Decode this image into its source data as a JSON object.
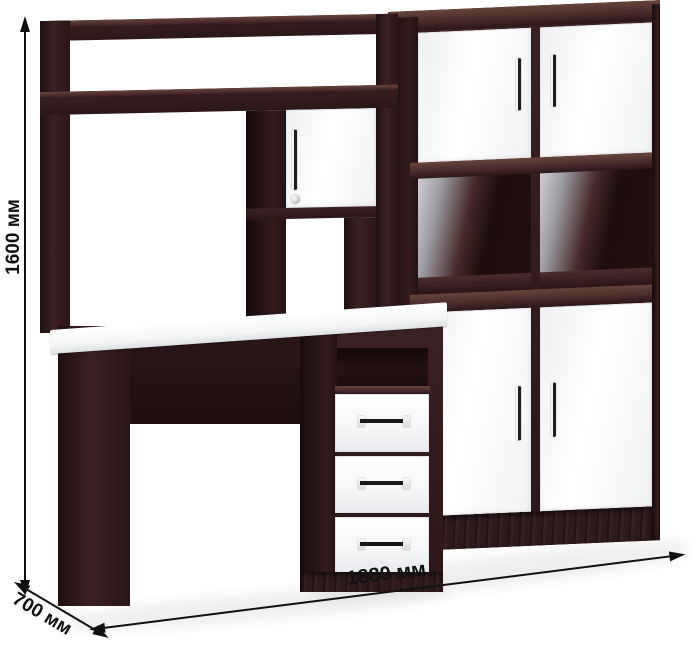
{
  "annotations": {
    "height_label": "1600 мм",
    "width_label": "1880 мм",
    "depth_label": "700 мм"
  },
  "palette": {
    "background": "#ffffff",
    "wood_dark": "#2b1618",
    "wood_mid": "#3a2123",
    "wood_highlight": "#66443a",
    "facade_white": "#fbfcfd",
    "back_panel_grey": "#9b9ba0",
    "handle_metal": "#1d1d1d",
    "annotation_color": "#101010"
  },
  "furniture": {
    "style": "dark wenge frame with glossy white facades",
    "hutch": {
      "open_top_shelf": true,
      "tall_open_bay": true,
      "small_doors": 1,
      "door_has_lock": true,
      "open_niche_below_door": true
    },
    "desk": {
      "desktop_color": "white",
      "open_niche": true,
      "drawers": 3,
      "kneehole_open": true
    },
    "cabinet": {
      "top_doors": 2,
      "open_compartments": 2,
      "bottom_doors": 2,
      "plinth": true
    }
  }
}
